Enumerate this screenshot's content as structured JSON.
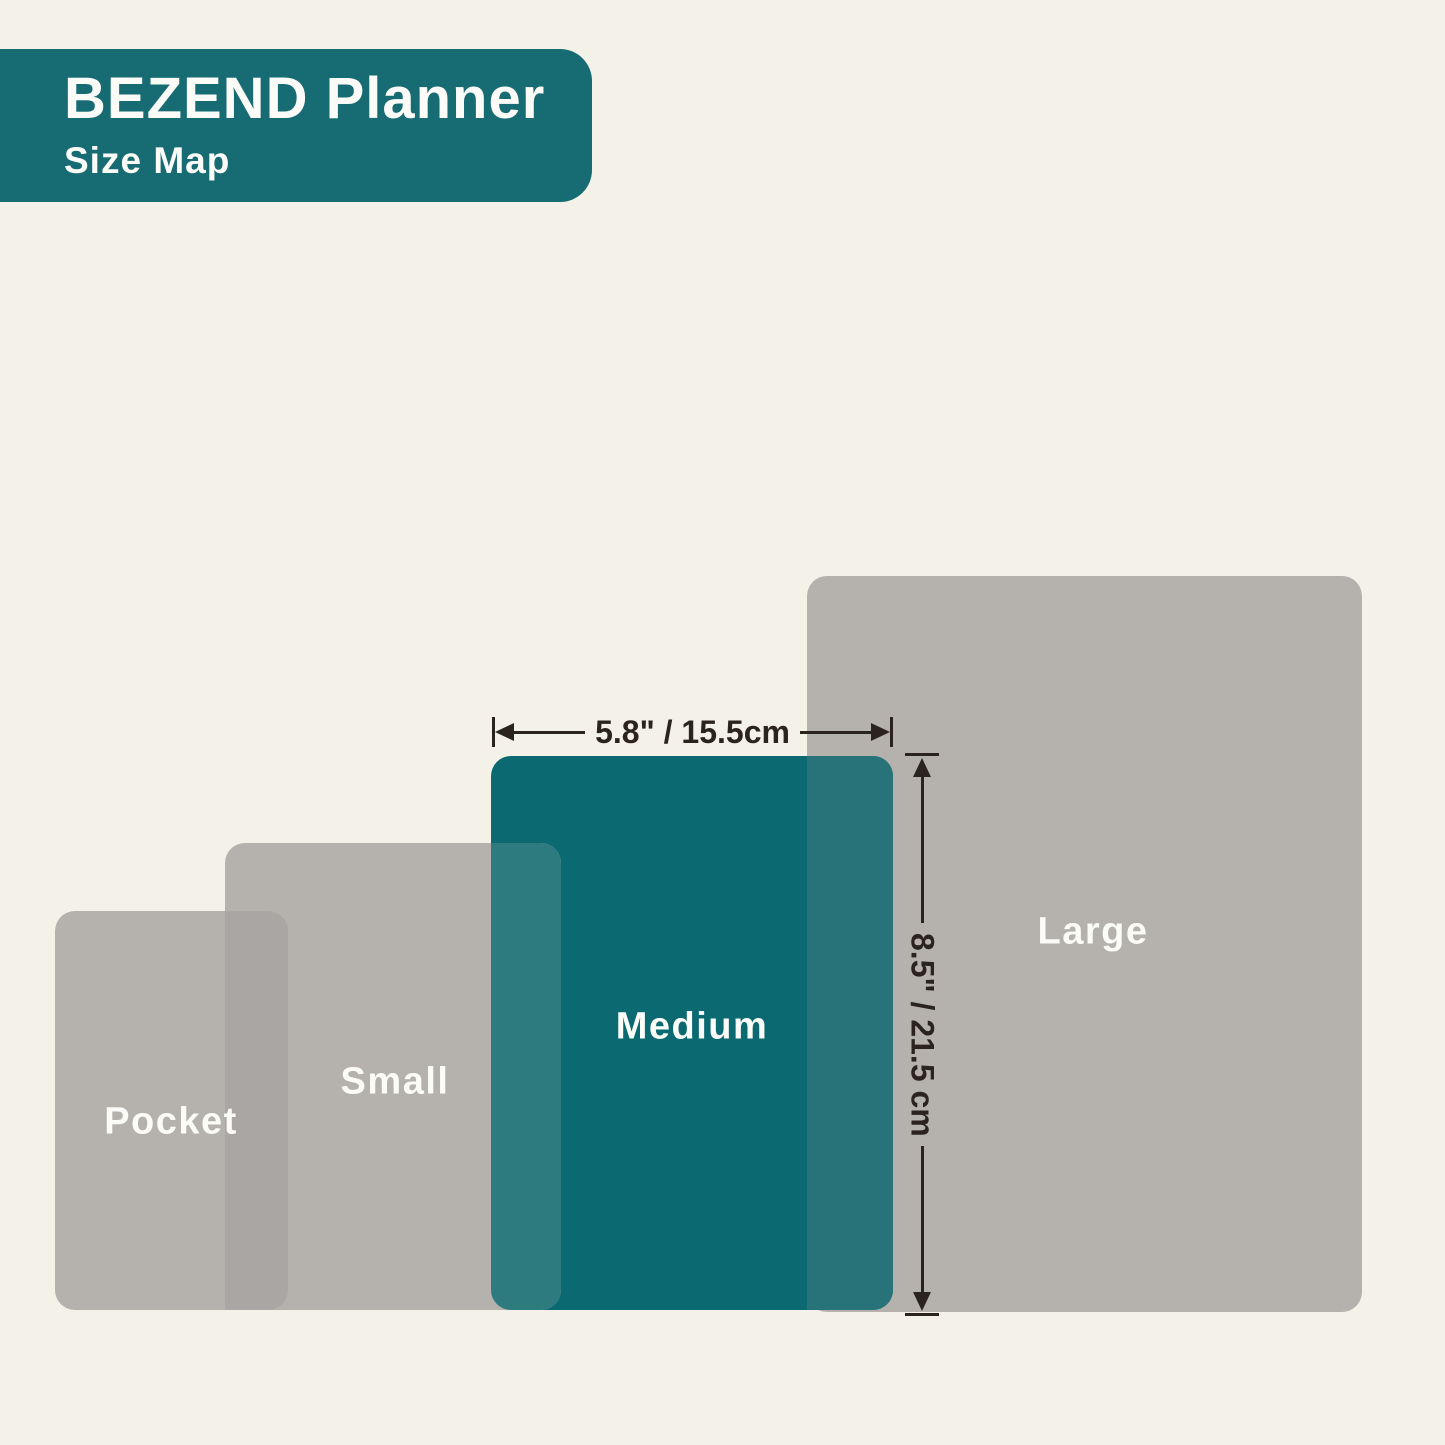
{
  "header": {
    "title": "BEZEND Planner",
    "subtitle": "Size Map"
  },
  "colors": {
    "bg": "#f4f1e8",
    "header_teal": "#176b72",
    "teal": "#0b6a71",
    "gray": "#b5b2ae",
    "gray_overlap": "#a9a6a3",
    "teal_wash": "#2d7a7f",
    "teal_wash2": "#28737a",
    "line": "#2b241e",
    "label": "#fbfbf8"
  },
  "diagram": {
    "sizes": [
      {
        "name": "Pocket"
      },
      {
        "name": "Small"
      },
      {
        "name": "Medium",
        "highlighted": true,
        "width": "5.8\" / 15.5cm",
        "height": "8.5\" / 21.5 cm"
      },
      {
        "name": "Large"
      }
    ]
  }
}
